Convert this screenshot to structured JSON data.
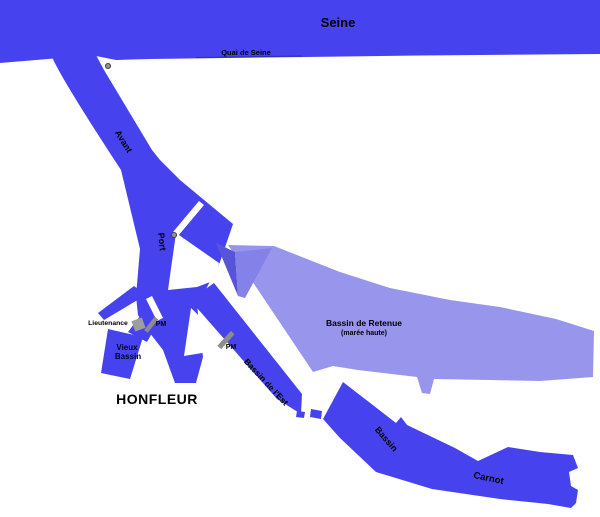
{
  "palette": {
    "water_dark": "#4643ee",
    "water_light": "#9896ec",
    "water_mid": "#8482e8",
    "water_shadow": "#5754d8",
    "land": "#ffffff",
    "quay_line": "#2e2bb8",
    "gray_structure": "#8c8c8c",
    "gray_building": "#9e9e9e",
    "dot_fill": "#919191",
    "dot_stroke": "#3c3c3c",
    "text": "#000000"
  },
  "map": {
    "labels": {
      "seine": "Seine",
      "quai_de_seine": "Quai de Seine",
      "avant": "Avant",
      "port": "Port",
      "lieutenance": "Lieutenance",
      "pm_vieux_bassin": "PM",
      "pm_bassin_est": "PM",
      "vieux_bassin_line1": "Vieux",
      "vieux_bassin_line2": "Bassin",
      "city": "HONFLEUR",
      "retenue_line1": "Bassin de Retenue",
      "retenue_line2": "(marée haute)",
      "bassin_est": "Bassin de l'Est",
      "carnot_line1": "Bassin",
      "carnot_line2": "Carnot"
    }
  }
}
